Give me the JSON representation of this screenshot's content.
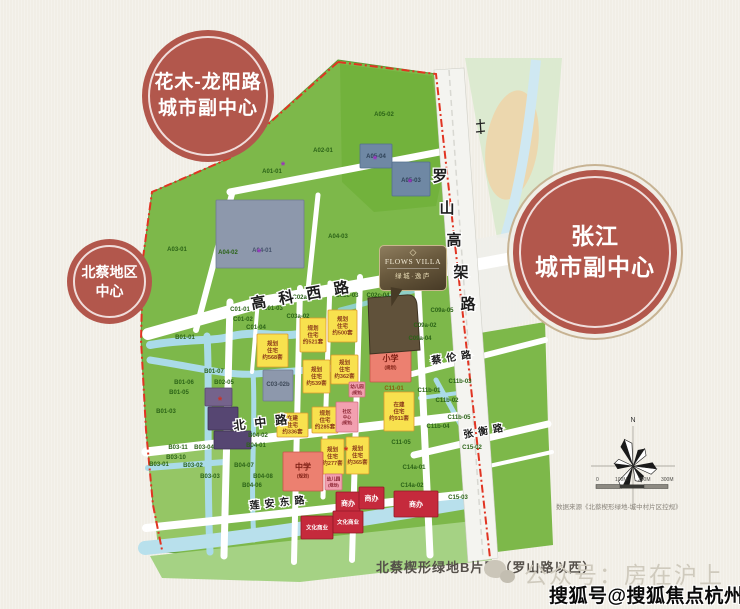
{
  "bubbles": {
    "huamu": {
      "line1": "花木-龙阳路",
      "line2": "城市副中心"
    },
    "beicai": {
      "line1": "北蔡地区",
      "line2": "中心"
    },
    "zhangjiang": {
      "line1": "张江",
      "line2": "城市副中心"
    }
  },
  "logo": {
    "diamond": "◇",
    "name": "FLOWS VILLA",
    "cn": "绿城·逸庐"
  },
  "caption": "北蔡楔形绿地B片区（罗山路以西）",
  "source_note": "数据来源《北蔡楔形绿地-城中村片区控规》",
  "watermarks": {
    "wechat": "公众号：房在沪上",
    "sohu": "搜狐号@搜狐焦点杭州站"
  },
  "compass": {
    "north_label": "N"
  },
  "scalebar": {
    "t0": "0",
    "t1": "100M",
    "t2": "200M",
    "t3": "300M"
  },
  "colors": {
    "bubble_red": "#b2574c",
    "land_green": "#7db84a",
    "water_blue": "#aadbe8",
    "plan_yellow": "#f8e14e",
    "school_red": "#ec8070",
    "commerce_red": "#c52a3c",
    "boundary_red": "#e13422",
    "site_bronze": "#60513a"
  },
  "roads": [
    {
      "text": "高科西路",
      "x": 252,
      "y": 309,
      "rotate": -10,
      "size": 15,
      "ls": 13
    },
    {
      "text": "罗山高架路",
      "x": 440,
      "y": 181,
      "vertical": true,
      "dx": 7,
      "dy": 32,
      "size": 15
    },
    {
      "text": "北中路",
      "x": 234,
      "y": 430,
      "rotate": -7,
      "size": 12,
      "ls": 9
    },
    {
      "text": "莲安东路",
      "x": 250,
      "y": 509,
      "rotate": -6,
      "size": 10,
      "ls": 5
    },
    {
      "text": "蔡伦路",
      "x": 432,
      "y": 364,
      "rotate": -9,
      "size": 10,
      "ls": 5
    },
    {
      "text": "张衡路",
      "x": 464,
      "y": 438,
      "rotate": -10,
      "size": 10,
      "ls": 5
    }
  ],
  "map": {
    "plots": [
      {
        "code": "A01-01",
        "x": 272,
        "y": 173
      },
      {
        "code": "A02-01",
        "x": 323,
        "y": 152
      },
      {
        "code": "A03-01",
        "x": 177,
        "y": 251
      },
      {
        "code": "A04-02",
        "x": 228,
        "y": 254
      },
      {
        "code": "A04-01",
        "x": 262,
        "y": 252,
        "c": "#44516b"
      },
      {
        "code": "A04-03",
        "x": 338,
        "y": 238
      },
      {
        "code": "A05-02",
        "x": 384,
        "y": 116
      },
      {
        "code": "A05-04",
        "x": 376,
        "y": 158,
        "c": "#2e4257"
      },
      {
        "code": "A05-03",
        "x": 411,
        "y": 182,
        "c": "#2e4257"
      },
      {
        "code": "B01-01",
        "x": 185,
        "y": 339
      },
      {
        "code": "B01-07",
        "x": 214,
        "y": 373
      },
      {
        "code": "B01-06",
        "x": 184,
        "y": 384
      },
      {
        "code": "B01-05",
        "x": 179,
        "y": 394
      },
      {
        "code": "B01-03",
        "x": 166,
        "y": 413
      },
      {
        "code": "B02-05",
        "x": 224,
        "y": 384
      },
      {
        "code": "B03-11",
        "x": 178,
        "y": 449
      },
      {
        "code": "B03-04",
        "x": 204,
        "y": 449
      },
      {
        "code": "B03-10",
        "x": 176,
        "y": 459
      },
      {
        "code": "B03-01",
        "x": 159,
        "y": 466
      },
      {
        "code": "B03-02",
        "x": 193,
        "y": 467
      },
      {
        "code": "B03-03",
        "x": 210,
        "y": 478
      },
      {
        "code": "B04-02",
        "x": 258,
        "y": 437
      },
      {
        "code": "B04-01",
        "x": 256,
        "y": 447
      },
      {
        "code": "B04-07",
        "x": 244,
        "y": 467
      },
      {
        "code": "B04-08",
        "x": 263,
        "y": 478
      },
      {
        "code": "B04-06",
        "x": 252,
        "y": 487
      },
      {
        "code": "C01-01",
        "x": 240,
        "y": 311
      },
      {
        "code": "C01-02",
        "x": 243,
        "y": 321
      },
      {
        "code": "C01-03",
        "x": 273,
        "y": 310
      },
      {
        "code": "C01-04",
        "x": 256,
        "y": 329
      },
      {
        "code": "C02a-01",
        "x": 304,
        "y": 299
      },
      {
        "code": "C03a-02",
        "x": 298,
        "y": 318
      },
      {
        "code": "C02c-03",
        "x": 347,
        "y": 297
      },
      {
        "code": "C02c-04",
        "x": 378,
        "y": 297
      },
      {
        "code": "C03-02b",
        "x": 278,
        "y": 386,
        "c": "#3c4757"
      },
      {
        "code": "C09a-05",
        "x": 442,
        "y": 312
      },
      {
        "code": "C09a-02",
        "x": 425,
        "y": 327
      },
      {
        "code": "C09a-04",
        "x": 420,
        "y": 340
      },
      {
        "code": "C11-01",
        "x": 394,
        "y": 390,
        "c": "#8b5e10"
      },
      {
        "code": "C11-05",
        "x": 401,
        "y": 444
      },
      {
        "code": "C11b-01",
        "x": 429,
        "y": 392
      },
      {
        "code": "C11b-02",
        "x": 447,
        "y": 402
      },
      {
        "code": "C11b-03",
        "x": 460,
        "y": 383
      },
      {
        "code": "C11b-04",
        "x": 438,
        "y": 428
      },
      {
        "code": "C11b-05",
        "x": 459,
        "y": 419
      },
      {
        "code": "C14a-01",
        "x": 414,
        "y": 469
      },
      {
        "code": "C14a-02",
        "x": 412,
        "y": 487
      },
      {
        "code": "C15-02",
        "x": 472,
        "y": 449
      },
      {
        "code": "C15-03",
        "x": 458,
        "y": 499
      }
    ],
    "blocks": [
      {
        "x": 216,
        "y": 200,
        "w": 88,
        "h": 68,
        "t": "g",
        "lines": []
      },
      {
        "x": 360,
        "y": 144,
        "w": 32,
        "h": 24,
        "t": "g2",
        "lines": []
      },
      {
        "x": 392,
        "y": 162,
        "w": 38,
        "h": 34,
        "t": "g2",
        "lines": []
      },
      {
        "x": 263,
        "y": 370,
        "w": 30,
        "h": 31,
        "t": "g",
        "lines": []
      },
      {
        "x": 205,
        "y": 388,
        "w": 27,
        "h": 18,
        "t": "u2",
        "lines": []
      },
      {
        "x": 208,
        "y": 407,
        "w": 30,
        "h": 23,
        "t": "u",
        "lines": []
      },
      {
        "x": 214,
        "y": 431,
        "w": 37,
        "h": 18,
        "t": "u",
        "lines": []
      },
      {
        "x": 328,
        "y": 310,
        "w": 29,
        "h": 32,
        "t": "y",
        "lines": [
          "规划",
          "住宅",
          "约500套"
        ]
      },
      {
        "x": 300,
        "y": 318,
        "w": 26,
        "h": 34,
        "t": "y",
        "lines": [
          "规划",
          "住宅",
          "约521套"
        ]
      },
      {
        "x": 257,
        "y": 334,
        "w": 31,
        "h": 33,
        "t": "y",
        "lines": [
          "规划",
          "住宅",
          "约568套"
        ]
      },
      {
        "x": 331,
        "y": 355,
        "w": 27,
        "h": 29,
        "t": "y",
        "lines": [
          "规划",
          "住宅",
          "约362套"
        ]
      },
      {
        "x": 303,
        "y": 360,
        "w": 27,
        "h": 33,
        "t": "y",
        "lines": [
          "规划",
          "住宅",
          "约539套"
        ]
      },
      {
        "x": 370,
        "y": 344,
        "w": 41,
        "h": 38,
        "t": "r",
        "lines": [
          "小学",
          "(规划)"
        ]
      },
      {
        "x": 349,
        "y": 382,
        "w": 16,
        "h": 15,
        "t": "p",
        "lines": [
          "幼儿园",
          "(规划)"
        ]
      },
      {
        "x": 277,
        "y": 413,
        "w": 31,
        "h": 24,
        "t": "y",
        "lines": [
          "在建",
          "住宅",
          "约336套"
        ]
      },
      {
        "x": 312,
        "y": 407,
        "w": 26,
        "h": 26,
        "t": "y",
        "lines": [
          "规划",
          "住宅",
          "约285套"
        ]
      },
      {
        "x": 336,
        "y": 402,
        "w": 22,
        "h": 30,
        "t": "p",
        "lines": [
          "社区",
          "中心",
          "(规划)"
        ]
      },
      {
        "x": 321,
        "y": 439,
        "w": 23,
        "h": 35,
        "t": "y",
        "lines": [
          "规划",
          "住宅",
          "约277套"
        ]
      },
      {
        "x": 346,
        "y": 437,
        "w": 23,
        "h": 37,
        "t": "y",
        "lines": [
          "规划",
          "住宅",
          "约365套"
        ]
      },
      {
        "x": 384,
        "y": 392,
        "w": 30,
        "h": 39,
        "t": "y",
        "lines": [
          "在建",
          "住宅",
          "约911套"
        ]
      },
      {
        "x": 283,
        "y": 452,
        "w": 40,
        "h": 39,
        "t": "r",
        "lines": [
          "中学",
          "(规划)"
        ]
      },
      {
        "x": 325,
        "y": 474,
        "w": 17,
        "h": 16,
        "t": "p",
        "lines": [
          "幼儿园",
          "(规划)"
        ]
      },
      {
        "x": 336,
        "y": 492,
        "w": 24,
        "h": 22,
        "t": "c",
        "lines": [
          "商办"
        ]
      },
      {
        "x": 359,
        "y": 487,
        "w": 25,
        "h": 22,
        "t": "c",
        "lines": [
          "商办"
        ]
      },
      {
        "x": 394,
        "y": 491,
        "w": 44,
        "h": 26,
        "t": "c",
        "lines": [
          "商办"
        ]
      },
      {
        "x": 301,
        "y": 516,
        "w": 32,
        "h": 23,
        "t": "c2",
        "lines": [
          "文化商业"
        ]
      },
      {
        "x": 333,
        "y": 511,
        "w": 30,
        "h": 22,
        "t": "c2",
        "lines": [
          "文化商业"
        ]
      }
    ],
    "markers": [
      {
        "x": 259,
        "y": 252,
        "c": "#9b30c0"
      },
      {
        "x": 283,
        "y": 165,
        "c": "#9b30c0"
      },
      {
        "x": 375,
        "y": 159,
        "c": "#9b30c0"
      },
      {
        "x": 410,
        "y": 182,
        "c": "#9b30c0"
      },
      {
        "x": 220,
        "y": 400,
        "c": "#d03020"
      },
      {
        "x": 346,
        "y": 450,
        "c": "#d03020"
      }
    ]
  }
}
